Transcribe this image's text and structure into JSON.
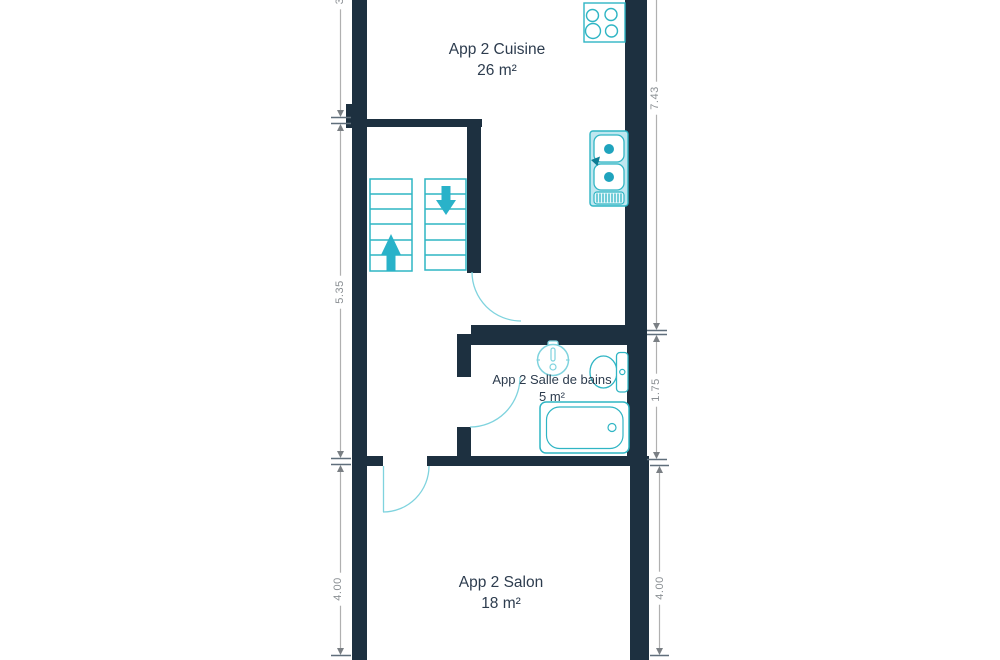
{
  "rooms": [
    {
      "label": "App 2 Cuisine",
      "area": "26 m²"
    },
    {
      "label": "App 2 Salle de bains",
      "area": "5 m²"
    },
    {
      "label": "App 2 Salon",
      "area": "18 m²"
    }
  ],
  "dimensions": {
    "left_top_partial": "3",
    "left_middle": "5.35",
    "left_bottom": "4.00",
    "right_top": "7.43",
    "right_middle": "1.75",
    "right_bottom": "4.00"
  },
  "fixtures": {
    "stove": "stove-burners-icon",
    "kitchen_sink": "kitchen-sink-icon",
    "stairs_up": "stairs-up-arrow-icon",
    "stairs_down": "stairs-down-arrow-icon",
    "washbasin": "washbasin-icon",
    "toilet": "toilet-icon",
    "bathtub": "bathtub-icon"
  },
  "colors": {
    "wall": "#1d3040",
    "fixture_stroke": "#2fb5c4",
    "fixture_fill_light": "#bfe7f0",
    "fixture_fill_solid": "#1fa3bd",
    "door_arc": "#7fd3de",
    "dimension_line": "#b0b0b0",
    "dimension_tick": "#5f6e7b",
    "dimension_text": "#8a8f93",
    "room_text": "#2d3c4e"
  }
}
